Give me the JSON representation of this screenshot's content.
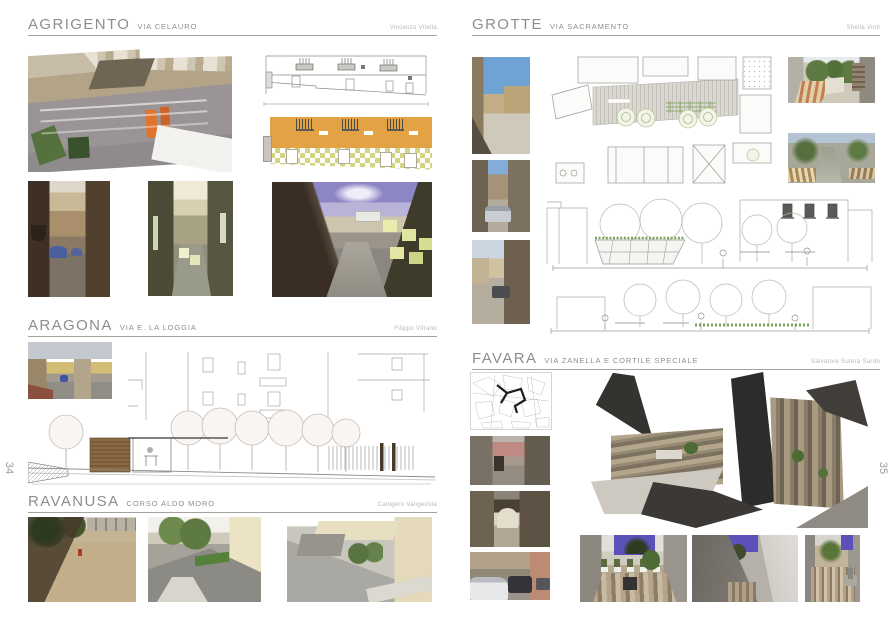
{
  "spread": {
    "left_page_number": "34",
    "right_page_number": "35"
  },
  "pages": {
    "left": {
      "number": "34",
      "sections": [
        {
          "id": "agrigento",
          "title": "AGRIGENTO",
          "subtitle": "VIA CELAURO",
          "author": "Vincenzo Vitella"
        },
        {
          "id": "aragona",
          "title": "ARAGONA",
          "subtitle": "VIA E. LA LOGGIA",
          "author": "Filippo Vitrano"
        },
        {
          "id": "ravanusa",
          "title": "RAVANUSA",
          "subtitle": "CORSO ALDO MORO",
          "author": "Calogero Vangelista"
        }
      ]
    },
    "right": {
      "number": "35",
      "sections": [
        {
          "id": "grotte",
          "title": "GROTTE",
          "subtitle": "VIA SACRAMENTO",
          "author": "Sheila Vinti"
        },
        {
          "id": "favara",
          "title": "FAVARA",
          "subtitle": "VIA ZANELLA E CORTILE SPECIALE",
          "author": "Salvatore Sutera Sardo"
        }
      ]
    }
  },
  "figures": {
    "agrigento": [
      "aerial photo collage of Via Celauro",
      "line elevation drawing",
      "coloured elevation with orange facade and checkered base",
      "alley photo with cafe umbrellas",
      "alley render with pale cubes",
      "wide alley render with glowing cubes"
    ],
    "aragona": [
      "street photo",
      "street elevation drawing with trees, timber kiosk and fence"
    ],
    "ravanusa": [
      "square photo with tree shadows",
      "street-level render with trees",
      "aerial render with cream buildings"
    ],
    "grotte": [
      "street photo 1",
      "street photo 2",
      "street photo 3",
      "paving plan with trees and pergola",
      "render with brick striped paving",
      "render with street trees",
      "section drawing with canopy and trees",
      "section drawing with hedge and trees"
    ],
    "favara": [
      "route map sketch",
      "alley photo 1",
      "alley photo with arch",
      "street photo with parked cars",
      "exploded axonometric collage of stone courtyard",
      "courtyard render with planters",
      "passage render",
      "narrow courtyard render"
    ]
  },
  "colors": {
    "facade_orange": "#e3a243",
    "checker_green": "#d3d582",
    "render_sky_purple": "#5b51b8",
    "pergola_green": "#76a356",
    "header_gray": "#8e8e8c"
  }
}
